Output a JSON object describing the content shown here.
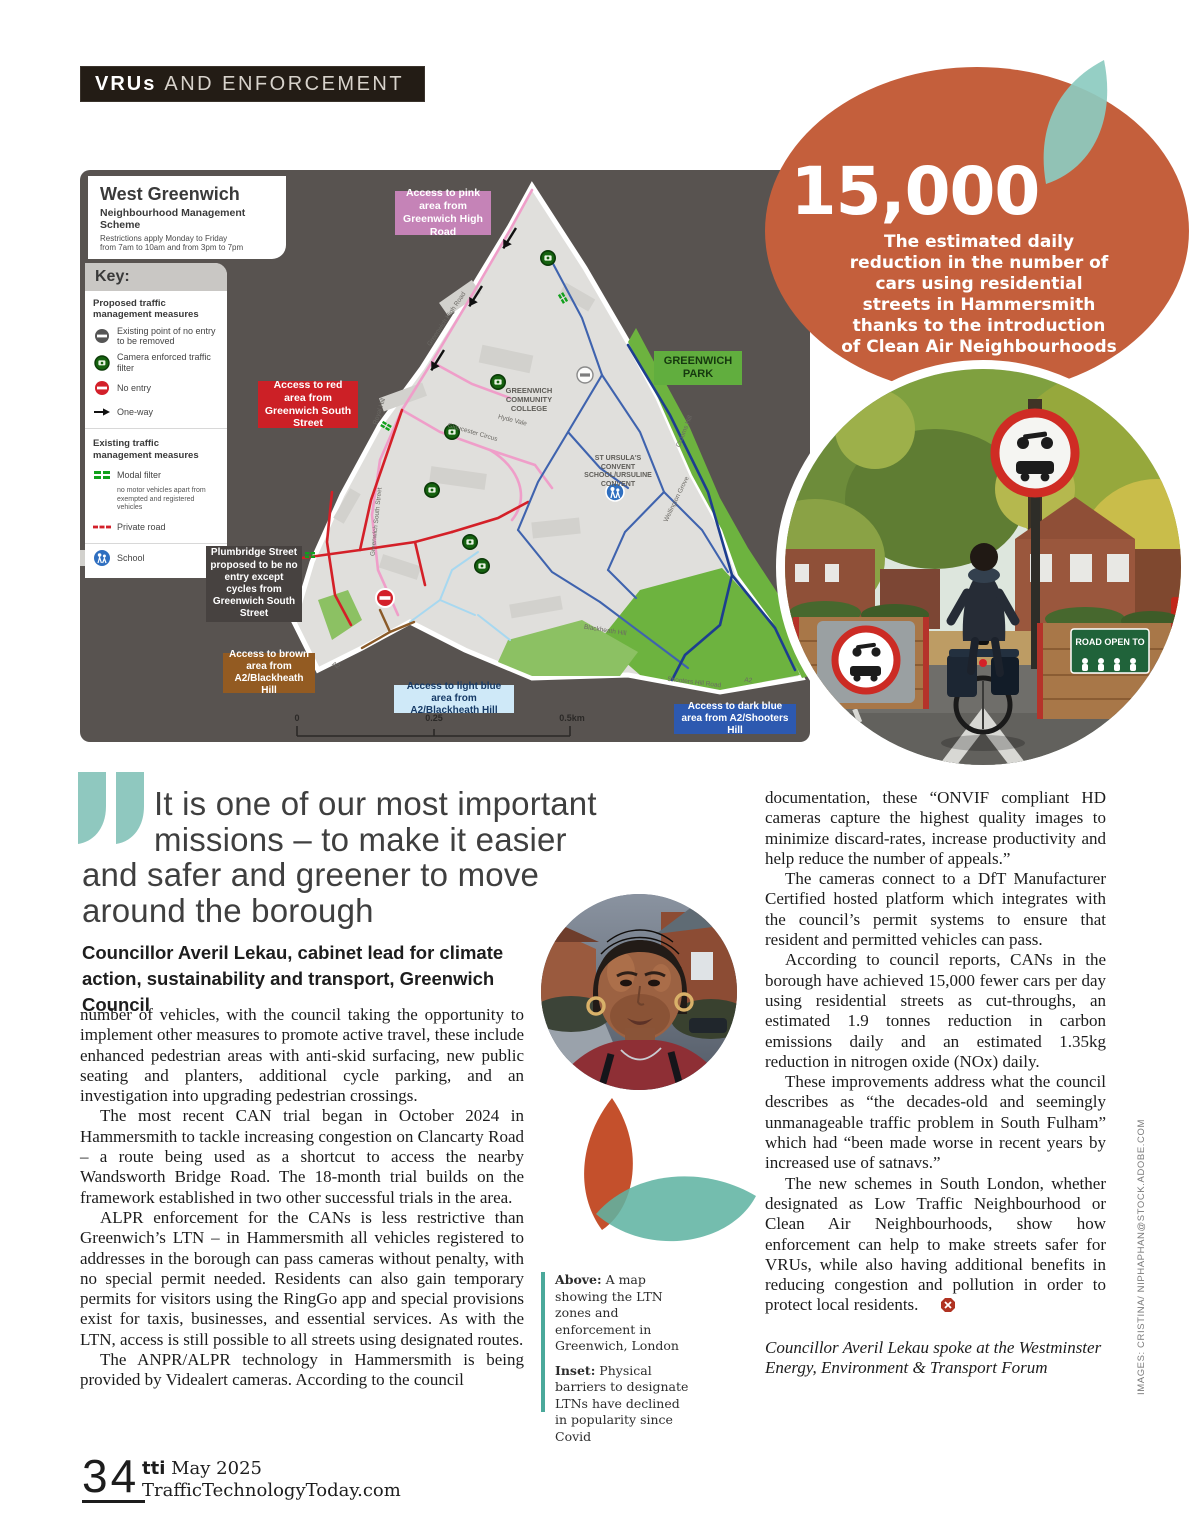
{
  "tag": {
    "bold": "VRUs",
    "rest": "AND ENFORCEMENT"
  },
  "map_card": {
    "title": "West Greenwich",
    "subtitle": "Neighbourhood Management Scheme",
    "note1": "Restrictions apply Monday to Friday",
    "note2": "from 7am to 10am and from 3pm to 7pm"
  },
  "map_key": {
    "heading": "Key:",
    "proposed_heading": "Proposed traffic management measures",
    "item_removed": "Existing point of no entry to be removed",
    "item_camera": "Camera enforced traffic filter",
    "item_noentry": "No entry",
    "item_oneway": "One-way",
    "existing_heading": "Existing traffic management measures",
    "item_modal": "Modal filter",
    "modal_note": "no motor vehicles apart from exempted and registered vehicles",
    "item_private": "Private road",
    "item_school": "School"
  },
  "map_labels": {
    "pink": "Access to pink area from Greenwich High Road",
    "red": "Access to red area from Greenwich South Street",
    "park": "GREENWICH PARK",
    "plumbridge": "Plumbridge Street proposed to be no entry except cycles from Greenwich South Street",
    "brown": "Access to brown area from A2/Blackheath Hill",
    "lightblue": "Access to light blue area from A2/Blackheath Hill",
    "darkblue": "Access to dark blue area from A2/Shooters Hill",
    "college": "GREENWICH COMMUNITY COLLEGE",
    "convent": "ST URSULA'S CONVENT SCHOOL/URSULINE CONVENT",
    "scale0": "0",
    "scale1": "0.25",
    "scale2": "0.5km"
  },
  "map_streets": [
    "Greenwich High Road",
    "Royal Hill",
    "Greenwich South Street",
    "Hyde Vale",
    "Crooms Hill",
    "Blackheath Hill",
    "Shooters Hill Road",
    "A2",
    "Gloucester Circus",
    "Wellington Grove"
  ],
  "stat": {
    "value": "15,000",
    "description": "The estimated daily reduction in the number of cars using residential streets in Hammersmith thanks to the introduction of Clean Air Neighbourhoods"
  },
  "photo_inset": {
    "road_open_sign": "ROAD OPEN TO"
  },
  "quote": {
    "lines": [
      "It is one of our most important",
      "missions – to make it easier",
      "and safer and greener to move",
      "around the borough"
    ],
    "attribution": "Councillor Averil Lekau, cabinet lead for climate action, sustainability and transport, Greenwich Council"
  },
  "article": {
    "col1": [
      "number of vehicles, with the council taking the opportunity to implement other measures to promote active travel, these include enhanced pedestrian areas with anti-skid surfacing, new public seating and planters, additional cycle parking, and an investigation into upgrading pedestrian crossings.",
      "The most recent CAN trial began in October 2024 in Hammersmith to tackle increasing congestion on Clancarty Road – a route being used as a shortcut to access the nearby Wandsworth Bridge Road. The 18-month trial builds on the framework established in two other successful trials in the area.",
      "ALPR enforcement for the CANs is less restrictive than Greenwich’s LTN – in Hammersmith all vehicles registered to addresses in the borough can pass cameras without penalty, with no special permit needed. Residents can also gain temporary permits for visitors using the RingGo app and special provisions exist for taxis, businesses, and essential services. As with the LTN, access is still possible to all streets using designated routes.",
      "The ANPR/ALPR technology in Hammersmith is being provided by Videalert cameras. According to the council"
    ],
    "col2": [
      "documentation, these “ONVIF compliant HD cameras capture the highest quality images to minimize discard-rates, increase productivity and help reduce the number of appeals.”",
      "The cameras connect to a DfT Manufacturer Certified hosted platform which integrates with the council’s permit systems to ensure that resident and permitted vehicles can pass.",
      "According to council reports, CANs in the borough have achieved 15,000 fewer cars per day using residential streets as cut-throughs, an estimated 1.9 tonnes reduction in carbon emissions daily and an estimated 1.35kg reduction in nitrogen oxide (NOx) daily.",
      "These improvements address what the council describes as “the decades-old and seemingly unmanageable traffic problem in South Fulham” which had “been made worse in recent years by increased use of satnavs.”",
      "The new schemes in South London, whether designated as Low Traffic Neighbourhood or Clean Air Neighbourhoods, show how enforcement can help to make streets safer for VRUs, while also having additional benefits in reducing congestion and pollution in order to protect local residents."
    ],
    "footnote": "Councillor Averil Lekau spoke at the Westminster Energy, Environment & Transport Forum"
  },
  "caption": {
    "above_label": "Above:",
    "above_text": " A map showing the LTN zones and enforcement in Greenwich, London",
    "inset_label": "Inset:",
    "inset_text": " Physical barriers to designate LTNs have declined in popularity since Covid"
  },
  "footer": {
    "page_number": "34",
    "brand": "tti",
    "issue": " May 2025",
    "site": "TrafficTechnologyToday.com"
  },
  "credits": "IMAGES: CRISTINA/ NIPHAPHAN@STOCK.ADOBE.COM"
}
